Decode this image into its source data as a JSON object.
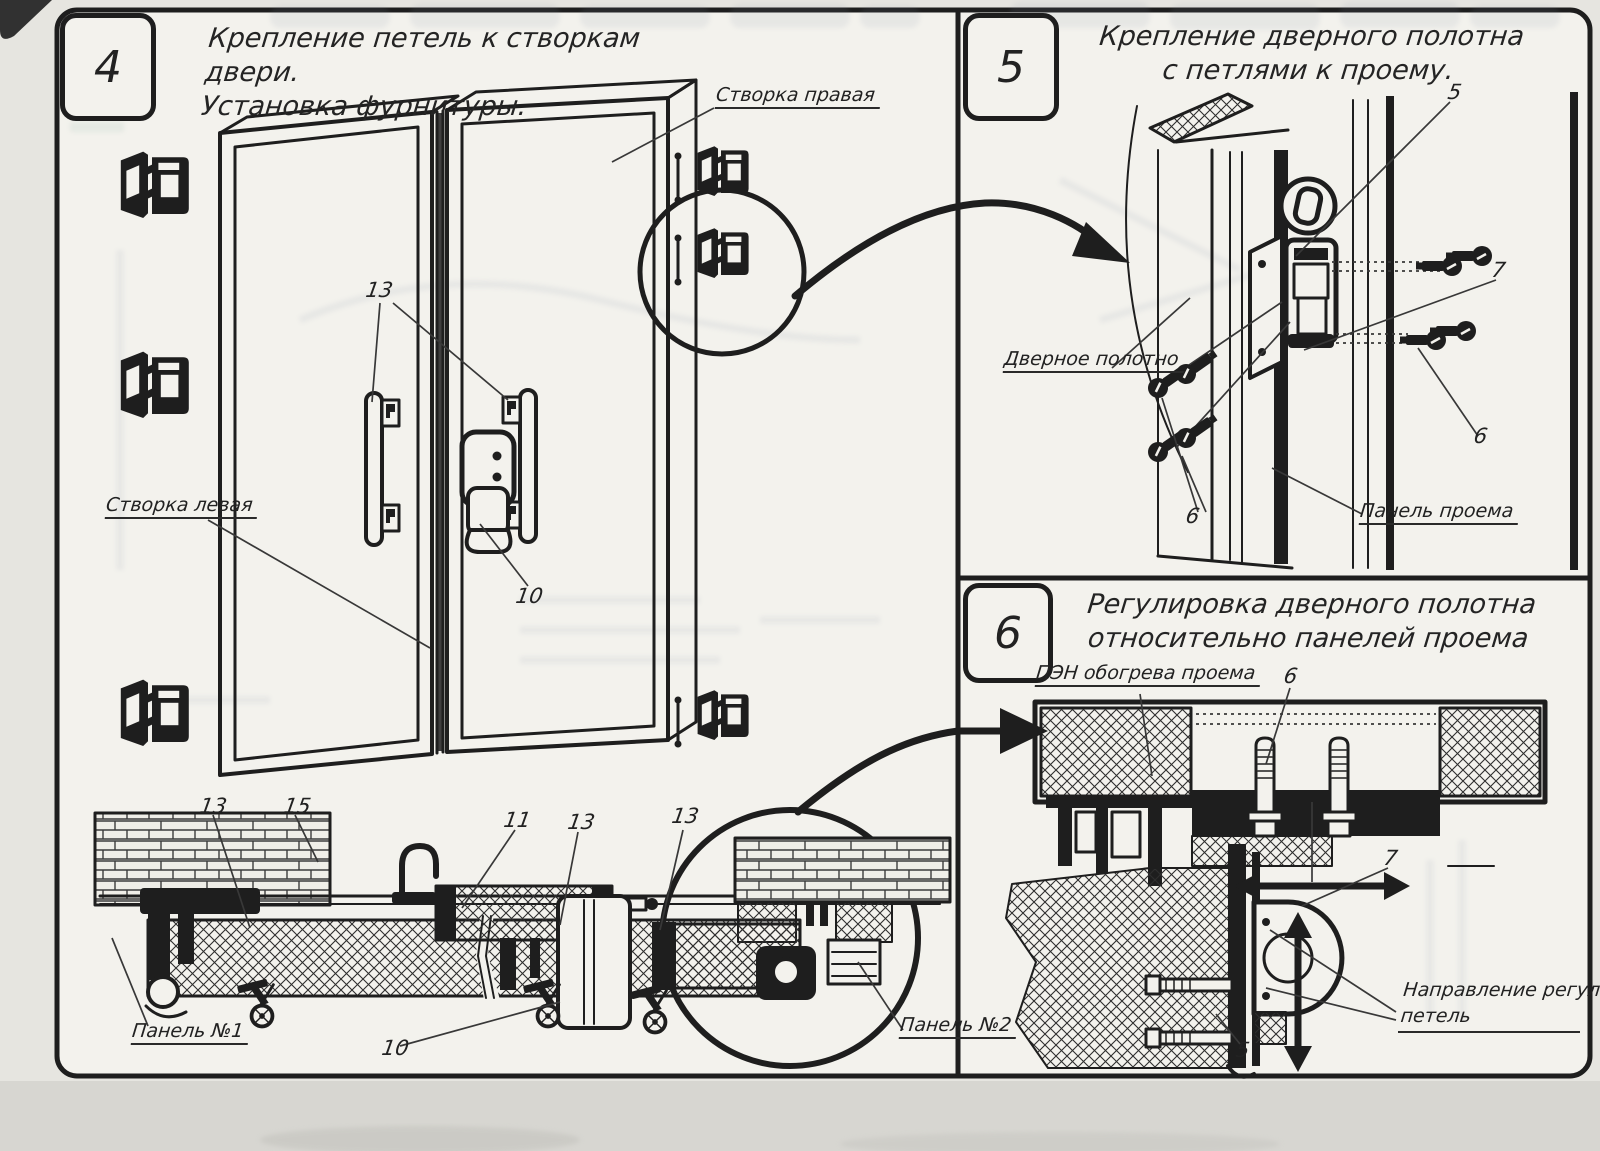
{
  "colors": {
    "ink": "#1e1e1e",
    "paper": "#f3f2ed",
    "page_bg": "#e6e5e0",
    "scan_band": "#d7d6d1"
  },
  "panel4": {
    "number": "4",
    "title_line1": "Крепление петель к створкам двери.",
    "title_line2": "Установка фурнитуры.",
    "labels": {
      "right_leaf": "Створка правая",
      "left_leaf": "Створка левая",
      "panel_1": "Панель №1",
      "panel_2": "Панель №2"
    },
    "callouts": {
      "handles": "13",
      "latch": "10",
      "section_left": "13",
      "hook": "15",
      "center": "11",
      "right": "13",
      "bottom": "10",
      "circle": "13"
    }
  },
  "panel5": {
    "number": "5",
    "title_line1": "Крепление дверного полотна",
    "title_line2": "с петлями к проему.",
    "labels": {
      "door_leaf": "Дверное полотно",
      "opening_panel": "Панель проема"
    },
    "callouts": {
      "top": "5",
      "middle": "7",
      "right": "6",
      "left": "6"
    }
  },
  "panel6": {
    "number": "6",
    "title_line1": "Регулировка дверного полотна",
    "title_line2": "относительно панелей проема",
    "labels": {
      "heater": "ПЭН обогрева проема",
      "direction_line1": "Направление регулировки",
      "direction_line2": "петель"
    },
    "callouts": {
      "bolt": "6",
      "hinge": "7",
      "bottom": "5"
    }
  }
}
